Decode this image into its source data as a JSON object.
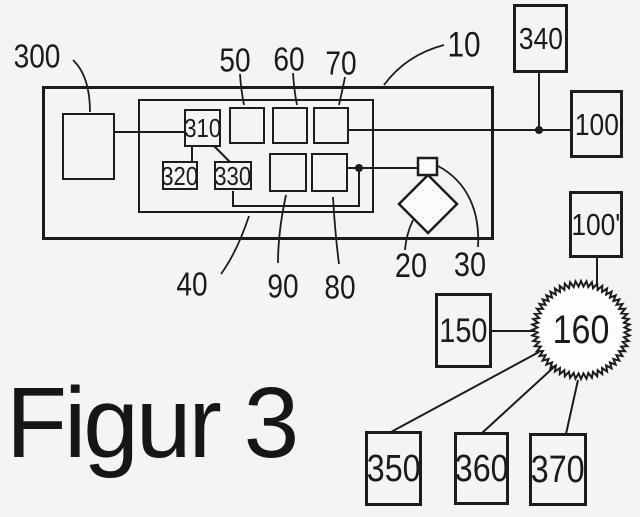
{
  "caption": "Figur 3",
  "refs": {
    "10": "10",
    "20": "20",
    "30": "30",
    "40": "40",
    "50": "50",
    "60": "60",
    "70": "70",
    "80": "80",
    "90": "90",
    "100": "100",
    "100p": "100'",
    "150": "150",
    "160": "160",
    "300": "300",
    "310": "310",
    "320": "320",
    "330": "330",
    "340": "340",
    "350": "350",
    "360": "360",
    "370": "370"
  },
  "colors": {
    "ink": "#1c1c1c",
    "background": "#f5f4f2",
    "shape_fill": "#fcfcfa"
  }
}
